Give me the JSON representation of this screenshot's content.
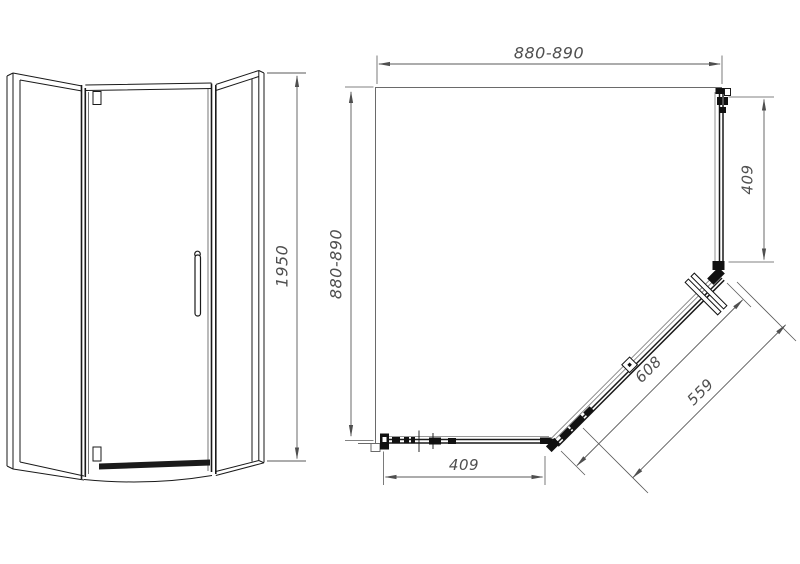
{
  "drawing": {
    "front_view": {
      "height_dim": "1950"
    },
    "plan_view": {
      "top_width_dim": "880-890",
      "left_depth_dim": "880-890",
      "right_panel_dim": "409",
      "bottom_panel_dim": "409",
      "door_dim": "608",
      "door_glass_dim": "559"
    },
    "colors": {
      "outline": "#1a1a1a",
      "wall": "#6a6a6a",
      "dimension": "#555555",
      "background": "#ffffff"
    }
  }
}
